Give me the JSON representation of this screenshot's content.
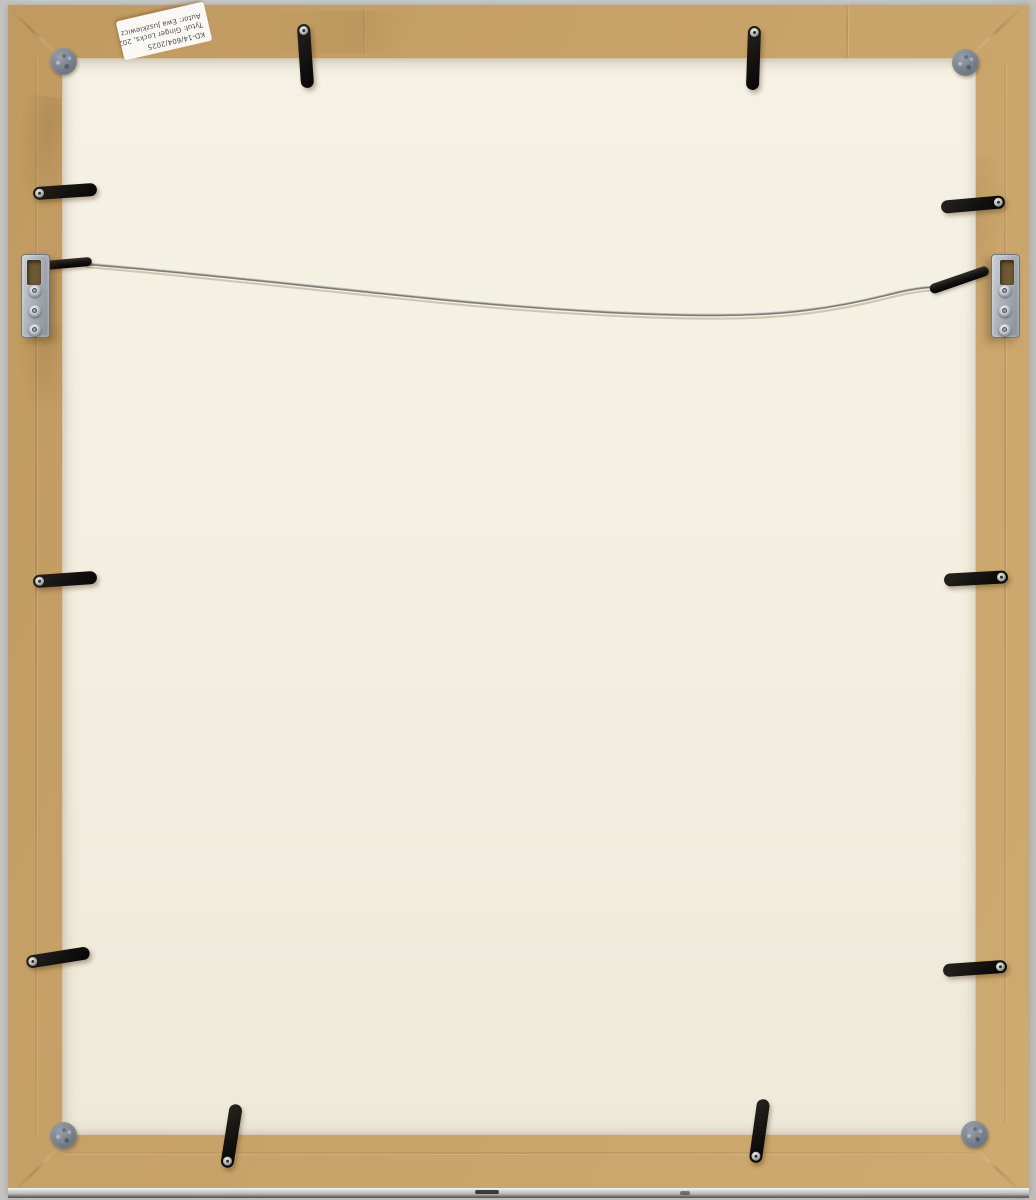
{
  "scene": {
    "label": {
      "line1": "KD-14/604/2025",
      "line2": "Tytuł: Ginger Locks, 2021",
      "line3": "Autor: Ewa Juszkiewicz"
    },
    "colors": {
      "backdrop": "#c9c8c6",
      "kraft_paper": "#c7a268",
      "backing_board": "#f3eee0",
      "clip_black": "#141210",
      "hanger_metal": "#aab1b8",
      "felt_pad": "#767d88",
      "wire": "#7d7b74",
      "label_bg": "#f9f8f4",
      "frame_edge_metal": "#bcbcba"
    },
    "hardware": {
      "flexi_clips": [
        {
          "side": "top",
          "x": 291,
          "y": 19,
          "angle": -4
        },
        {
          "side": "top",
          "x": 739,
          "y": 21,
          "angle": 2
        },
        {
          "side": "left",
          "x": 25,
          "y": 180,
          "angle": -4
        },
        {
          "side": "left",
          "x": 25,
          "y": 568,
          "angle": -4
        },
        {
          "side": "left",
          "x": 18,
          "y": 946,
          "angle": -9
        },
        {
          "side": "right",
          "x": 933,
          "y": 193,
          "angle": -5
        },
        {
          "side": "right",
          "x": 936,
          "y": 567,
          "angle": -3
        },
        {
          "side": "right",
          "x": 935,
          "y": 957,
          "angle": -4
        },
        {
          "side": "bottom",
          "x": 217,
          "y": 1099,
          "angle": 9
        },
        {
          "side": "bottom",
          "x": 745,
          "y": 1094,
          "angle": 8
        }
      ],
      "felt_pads": [
        {
          "corner": "top-left",
          "x": 42,
          "y": 43
        },
        {
          "corner": "top-right",
          "x": 944,
          "y": 44
        },
        {
          "corner": "bottom-left",
          "x": 42,
          "y": 1117
        },
        {
          "corner": "bottom-right",
          "x": 953,
          "y": 1116
        }
      ],
      "strap_hangers": [
        "left",
        "right"
      ],
      "hanging_wire": "steel"
    }
  }
}
